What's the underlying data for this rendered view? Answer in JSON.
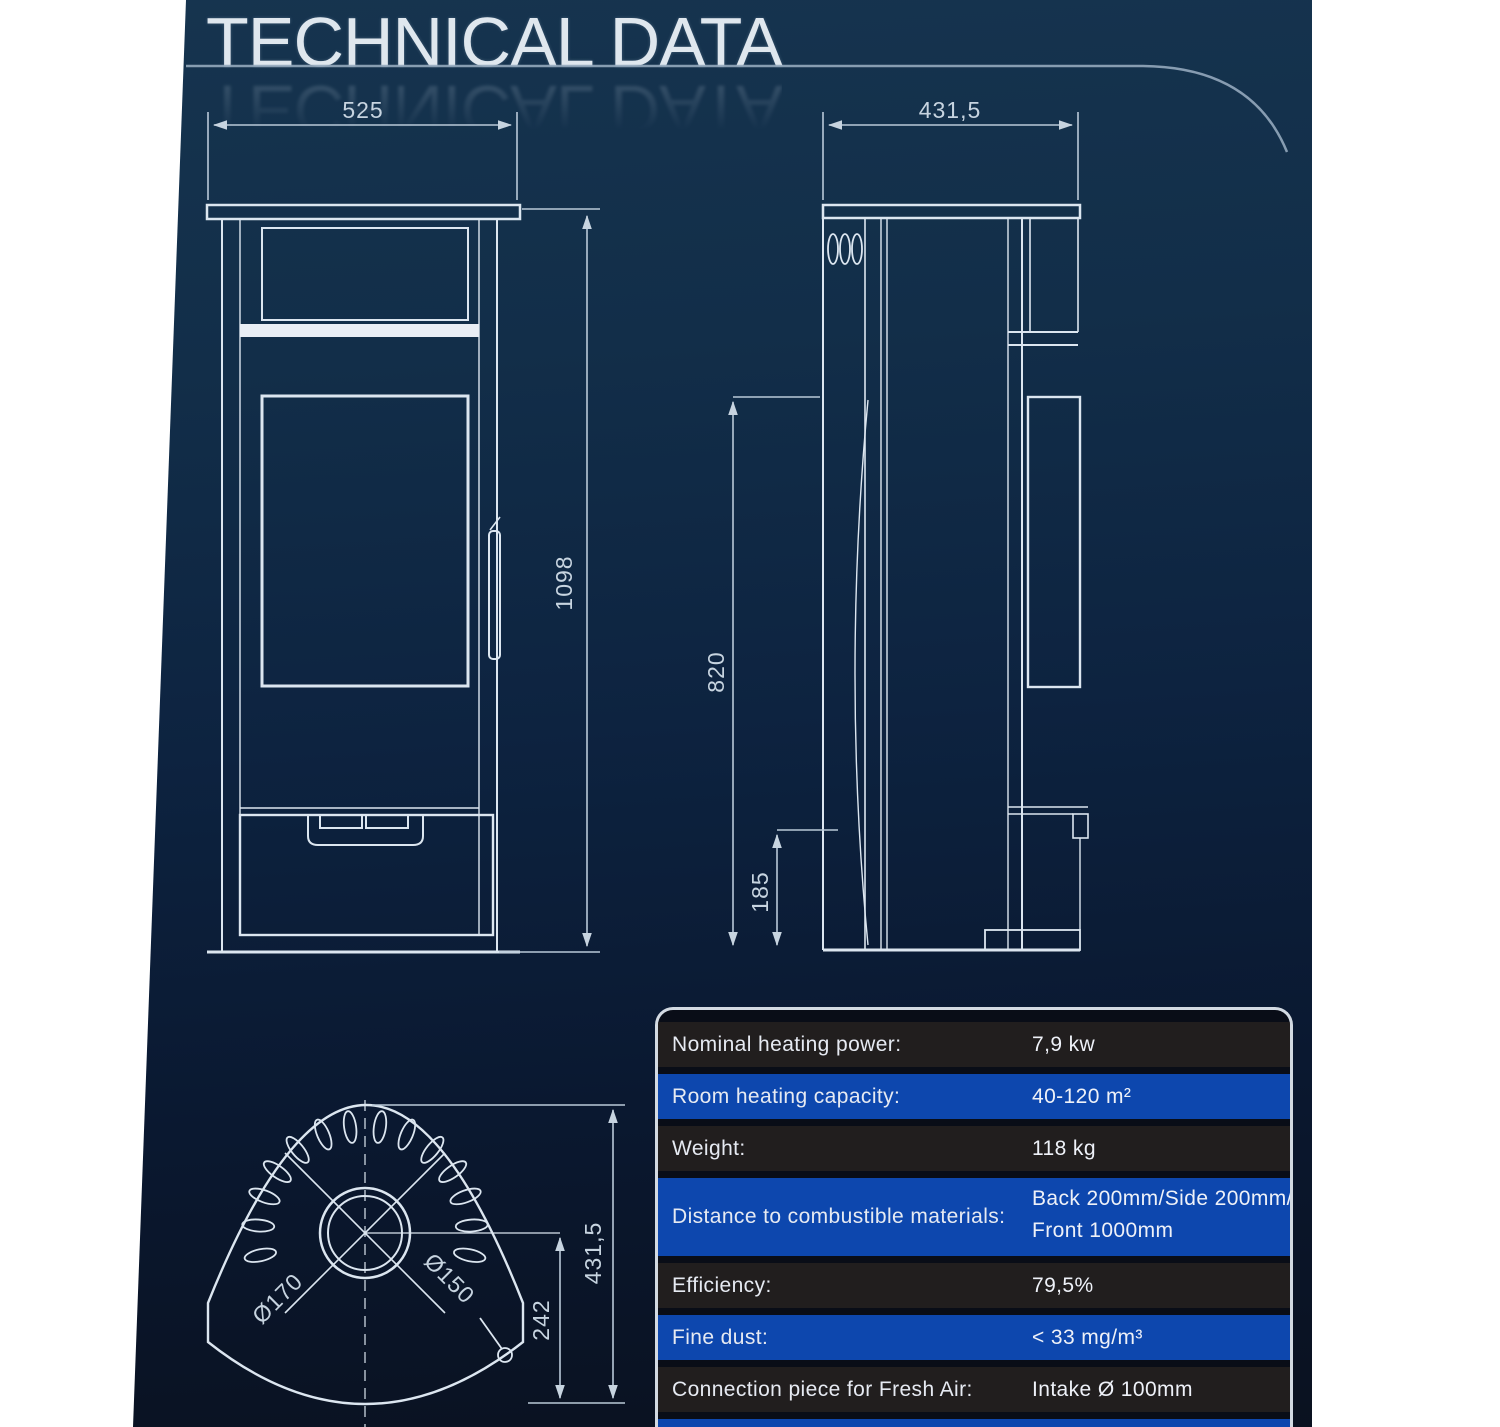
{
  "page": {
    "title": "TECHNICAL DATA",
    "colors": {
      "background_top": "#16344f",
      "background_bottom": "#0a111f",
      "drawing_line": "#dce6f0",
      "dimension_line": "#b9c9d8",
      "table_row_dark": "#211e1e",
      "table_row_blue": "#0d47ae",
      "table_border": "#d3dae2",
      "page_margin": "#ffffff"
    }
  },
  "drawings": {
    "front_view": {
      "width_label": "525",
      "height_label": "1098"
    },
    "side_view": {
      "depth_label": "431,5",
      "upper_edge_label": "820",
      "base_label": "185"
    },
    "top_view": {
      "outer_flue_label": "Ø170",
      "inner_flue_label": "Ø150",
      "offset_label": "242",
      "depth_label": "431,5"
    }
  },
  "table": {
    "rows": [
      {
        "label": "Nominal heating power:",
        "value": "7,9 kw"
      },
      {
        "label": "Room heating capacity:",
        "value": "40-120 m²"
      },
      {
        "label": "Weight:",
        "value": "118 kg"
      },
      {
        "label": "Distance to combustible materials:",
        "value_lines": [
          "Back 200mm/Side 200mm/",
          "Front 1000mm"
        ]
      },
      {
        "label": "Efficiency:",
        "value": "79,5%"
      },
      {
        "label": "Fine dust:",
        "value": "< 33 mg/m³"
      },
      {
        "label": "Connection piece for Fresh Air:",
        "value": "Intake Ø 100mm"
      }
    ]
  }
}
